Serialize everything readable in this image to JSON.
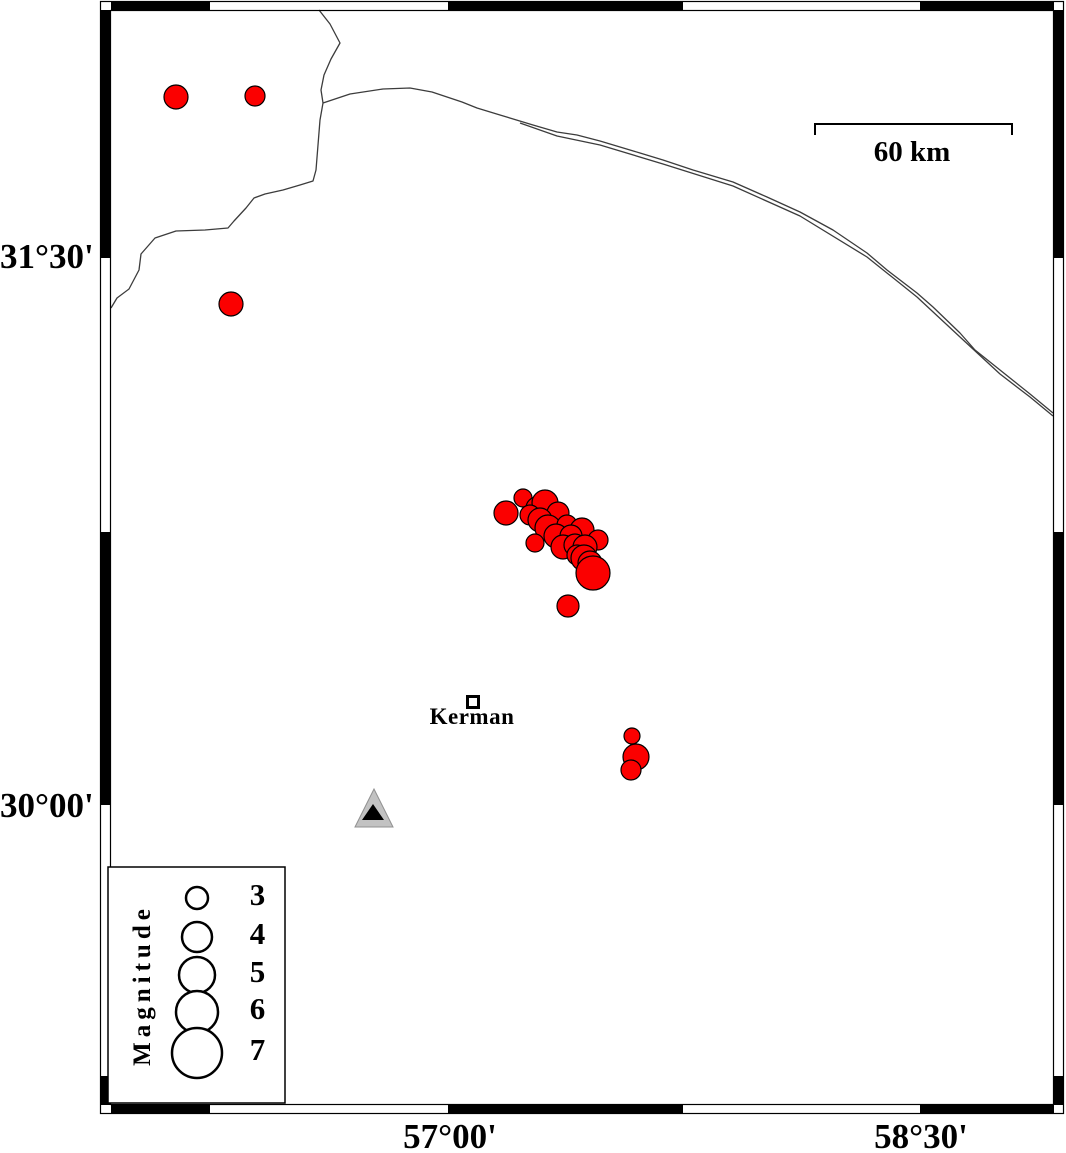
{
  "map": {
    "axis": {
      "left": [
        {
          "text": "31°30'",
          "y": 257
        },
        {
          "text": "30°00'",
          "y": 806
        }
      ],
      "bottom": [
        {
          "text": "57°00'",
          "x": 450
        },
        {
          "text": "58°30'",
          "x": 921
        }
      ]
    },
    "scale_bar": {
      "label": "60 km",
      "bracket": "815,135 815,124 1012,124 1012,135"
    },
    "city": {
      "name": "Kerman",
      "marker": [
        467.5,
        696.5,
        11,
        11
      ]
    },
    "station": {
      "outer": "374,789 355,827 393,827",
      "inner": "373,804 362,820 384,820"
    },
    "colors": {
      "epicenter": "#fb0000",
      "outline": "#000000",
      "fault": "#3c3c3c",
      "station_fill": "#c2c2c2",
      "station_edge": "#909090"
    },
    "faults": [
      {
        "points": "319,10 330,24 340,43 331,59 324,75 321,90 323,103 320,120 318,145 316,170 313,181 300,185 283,190 265,194 254,198 246,208 234,221 228,228 205,230 176,231 155,238 141,254 139,270 129,289 117,298 111,308"
      },
      {
        "points": "323,103 350,94 383,89 410,88 432,92 447,97 462,102 477,108 500,115 533,125 557,132 577,135 600,141 640,153 663,160 693,170 733,182 767,197 800,212 833,230 867,253 887,270 917,293 933,307 960,333 975,350 1000,370 1030,394 1053,413"
      },
      {
        "points": "520,123 557,136 600,145 663,164 733,186 800,216 867,257 917,297 960,337 1000,374 1030,397 1053,416"
      }
    ],
    "epicenters": [
      [
        176,
        97,
        12
      ],
      [
        255,
        96,
        10
      ],
      [
        231,
        304,
        12
      ],
      [
        506,
        513,
        12
      ],
      [
        523,
        498,
        9
      ],
      [
        537,
        508,
        11
      ],
      [
        545,
        503,
        13
      ],
      [
        558,
        513,
        11
      ],
      [
        530,
        515,
        10
      ],
      [
        540,
        520,
        12
      ],
      [
        548,
        528,
        13
      ],
      [
        567,
        525,
        10
      ],
      [
        582,
        530,
        12
      ],
      [
        598,
        540,
        10
      ],
      [
        556,
        536,
        12
      ],
      [
        571,
        536,
        11
      ],
      [
        535,
        543,
        9
      ],
      [
        563,
        547,
        12
      ],
      [
        575,
        545,
        11
      ],
      [
        585,
        547,
        12
      ],
      [
        577,
        555,
        10
      ],
      [
        584,
        558,
        13
      ],
      [
        590,
        563,
        12
      ],
      [
        593,
        573,
        17
      ],
      [
        568,
        606,
        11
      ],
      [
        632,
        736,
        8
      ],
      [
        636,
        757,
        13
      ],
      [
        631,
        770,
        10
      ]
    ],
    "legend": {
      "title": "Magnitude",
      "box": [
        108,
        867,
        177,
        236
      ],
      "circle_cx": 197,
      "items": [
        {
          "label": "3",
          "cy": 898,
          "r": 11
        },
        {
          "label": "4",
          "cy": 937,
          "r": 15
        },
        {
          "label": "5",
          "cy": 975,
          "r": 18
        },
        {
          "label": "6",
          "cy": 1012,
          "r": 21
        },
        {
          "label": "7",
          "cy": 1053,
          "r": 25
        }
      ]
    },
    "frame": {
      "outer": [
        100.5,
        1.5,
        963,
        1112
      ],
      "inner": [
        110.5,
        10.5,
        943,
        1094
      ],
      "black_rects": [
        [
          111,
          2,
          99,
          8
        ],
        [
          448,
          2,
          235,
          8
        ],
        [
          920,
          2,
          134,
          8
        ],
        [
          111,
          1105,
          99,
          8
        ],
        [
          448,
          1105,
          235,
          8
        ],
        [
          920,
          1105,
          134,
          8
        ],
        [
          101,
          10,
          9,
          248
        ],
        [
          101,
          532,
          9,
          273
        ],
        [
          101,
          1076,
          9,
          29
        ],
        [
          1054,
          10,
          9,
          248
        ],
        [
          1054,
          532,
          9,
          273
        ],
        [
          1054,
          1076,
          9,
          29
        ]
      ]
    }
  }
}
